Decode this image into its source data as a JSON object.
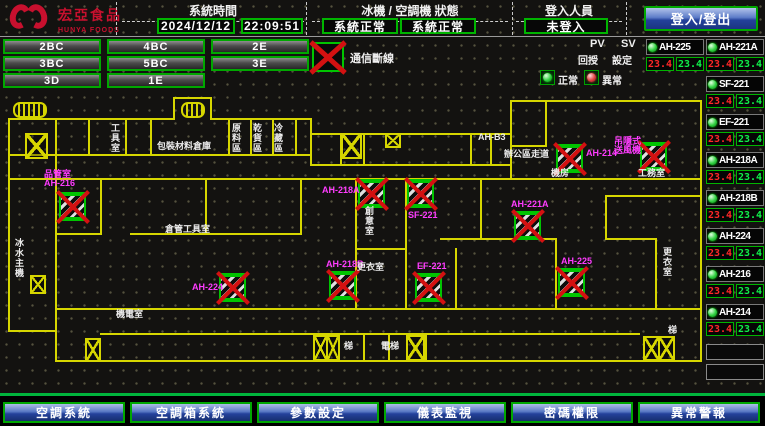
{
  "header": {
    "logo": {
      "name": "宏亞食品",
      "sub": "HUNYA FOODS"
    },
    "system_time": {
      "title": "系統時間",
      "date": "2024/12/12",
      "time": "22:09:51"
    },
    "status_panel": {
      "title": "冰機 / 空調機 狀態",
      "chiller_status": "系統正常",
      "ac_status": "系統正常"
    },
    "login_panel": {
      "title": "登入人員",
      "status": "未登入"
    },
    "login_button": "登入/登出"
  },
  "floor_buttons": [
    {
      "label": "2BC"
    },
    {
      "label": "4BC"
    },
    {
      "label": "2E"
    },
    {
      "label": "3BC"
    },
    {
      "label": "5BC"
    },
    {
      "label": "3E"
    },
    {
      "label": "3D"
    },
    {
      "label": "1E"
    }
  ],
  "legend": {
    "comm_loss": "通信斷線",
    "pv_label": "PV",
    "sv_label": "SV",
    "feedback_label": "回授",
    "setting_label": "設定",
    "normal_label": "正常",
    "abnormal_label": "異常"
  },
  "sidebar": {
    "units": [
      {
        "name": "AH-225",
        "pv": "23.4",
        "sv": "23.4",
        "status": "normal"
      },
      {
        "name": "AH-221A",
        "pv": "23.4",
        "sv": "23.4",
        "status": "normal"
      },
      {
        "name": "SF-221",
        "pv": "23.4",
        "sv": "23.4",
        "status": "normal"
      },
      {
        "name": "EF-221",
        "pv": "23.4",
        "sv": "23.4",
        "status": "normal"
      },
      {
        "name": "AH-218A",
        "pv": "23.4",
        "sv": "23.4",
        "status": "normal"
      },
      {
        "name": "AH-218B",
        "pv": "23.4",
        "sv": "23.4",
        "status": "normal"
      },
      {
        "name": "AH-224",
        "pv": "23.4",
        "sv": "23.4",
        "status": "normal"
      },
      {
        "name": "AH-216",
        "pv": "23.4",
        "sv": "23.4",
        "status": "normal"
      },
      {
        "name": "AH-214",
        "pv": "23.4",
        "sv": "23.4",
        "status": "normal"
      }
    ]
  },
  "map": {
    "devices": [
      {
        "name": "AH-216",
        "label": "品管室\nAH-216",
        "comm_loss": true,
        "x": 59,
        "y": 192,
        "lx": 44,
        "ly": 170
      },
      {
        "name": "AH-218A",
        "label": "AH-218A",
        "comm_loss": true,
        "x": 358,
        "y": 179,
        "lx": 322,
        "ly": 186
      },
      {
        "name": "SF-221",
        "label": "SF-221",
        "comm_loss": true,
        "x": 407,
        "y": 179,
        "lx": 408,
        "ly": 211
      },
      {
        "name": "AH-214",
        "label": "AH-214",
        "comm_loss": true,
        "x": 556,
        "y": 144,
        "lx": 586,
        "ly": 149
      },
      {
        "name": "FAN-B3",
        "label": "吊隱式\n送風機",
        "comm_loss": true,
        "x": 640,
        "y": 142,
        "lx": 614,
        "ly": 137
      },
      {
        "name": "AH-221A",
        "label": "AH-221A",
        "comm_loss": true,
        "x": 514,
        "y": 211,
        "lx": 511,
        "ly": 200
      },
      {
        "name": "AH-225",
        "label": "AH-225",
        "comm_loss": true,
        "x": 558,
        "y": 268,
        "lx": 561,
        "ly": 257
      },
      {
        "name": "AH-224",
        "label": "AH-224",
        "comm_loss": true,
        "x": 219,
        "y": 273,
        "lx": 192,
        "ly": 283
      },
      {
        "name": "AH-218B",
        "label": "AH-218B",
        "comm_loss": true,
        "x": 329,
        "y": 271,
        "lx": 326,
        "ly": 260
      },
      {
        "name": "EF-221",
        "label": "EF-221",
        "comm_loss": true,
        "x": 415,
        "y": 273,
        "lx": 417,
        "ly": 262
      }
    ],
    "rooms": [
      {
        "text": "工具室",
        "x": 110,
        "y": 123,
        "v": true
      },
      {
        "text": "包裝材料倉庫",
        "x": 157,
        "y": 141
      },
      {
        "text": "原料區",
        "x": 231,
        "y": 123,
        "v": true
      },
      {
        "text": "乾貨區",
        "x": 252,
        "y": 123,
        "v": true
      },
      {
        "text": "冷藏區",
        "x": 273,
        "y": 123,
        "v": true
      },
      {
        "text": "AH-B3",
        "x": 478,
        "y": 132
      },
      {
        "text": "辦公區走道",
        "x": 504,
        "y": 149
      },
      {
        "text": "創意室",
        "x": 364,
        "y": 206,
        "v": true
      },
      {
        "text": "更衣室",
        "x": 357,
        "y": 262
      },
      {
        "text": "倉管工具室",
        "x": 165,
        "y": 224
      },
      {
        "text": "機電室",
        "x": 116,
        "y": 309
      },
      {
        "text": "冰水主機",
        "x": 14,
        "y": 238,
        "v": true
      },
      {
        "text": "梯",
        "x": 344,
        "y": 341
      },
      {
        "text": "電梯",
        "x": 381,
        "y": 341
      },
      {
        "text": "梯",
        "x": 668,
        "y": 325
      },
      {
        "text": "更衣室",
        "x": 662,
        "y": 247,
        "v": true
      },
      {
        "text": "機房",
        "x": 551,
        "y": 168
      },
      {
        "text": "工務室",
        "x": 638,
        "y": 168
      }
    ]
  },
  "nav_buttons": [
    {
      "label": "空調系統"
    },
    {
      "label": "空調箱系統"
    },
    {
      "label": "參數設定"
    },
    {
      "label": "儀表監視"
    },
    {
      "label": "密碼權限"
    },
    {
      "label": "異常警報"
    }
  ],
  "colors": {
    "accent_green": "#00b400",
    "alarm_red": "#d31111",
    "label_magenta": "#ff3cff",
    "wall_yellow": "#d6d600",
    "nav_blue": "#24419b",
    "pv_red": "#ff2828",
    "sv_green": "#10f04a"
  }
}
